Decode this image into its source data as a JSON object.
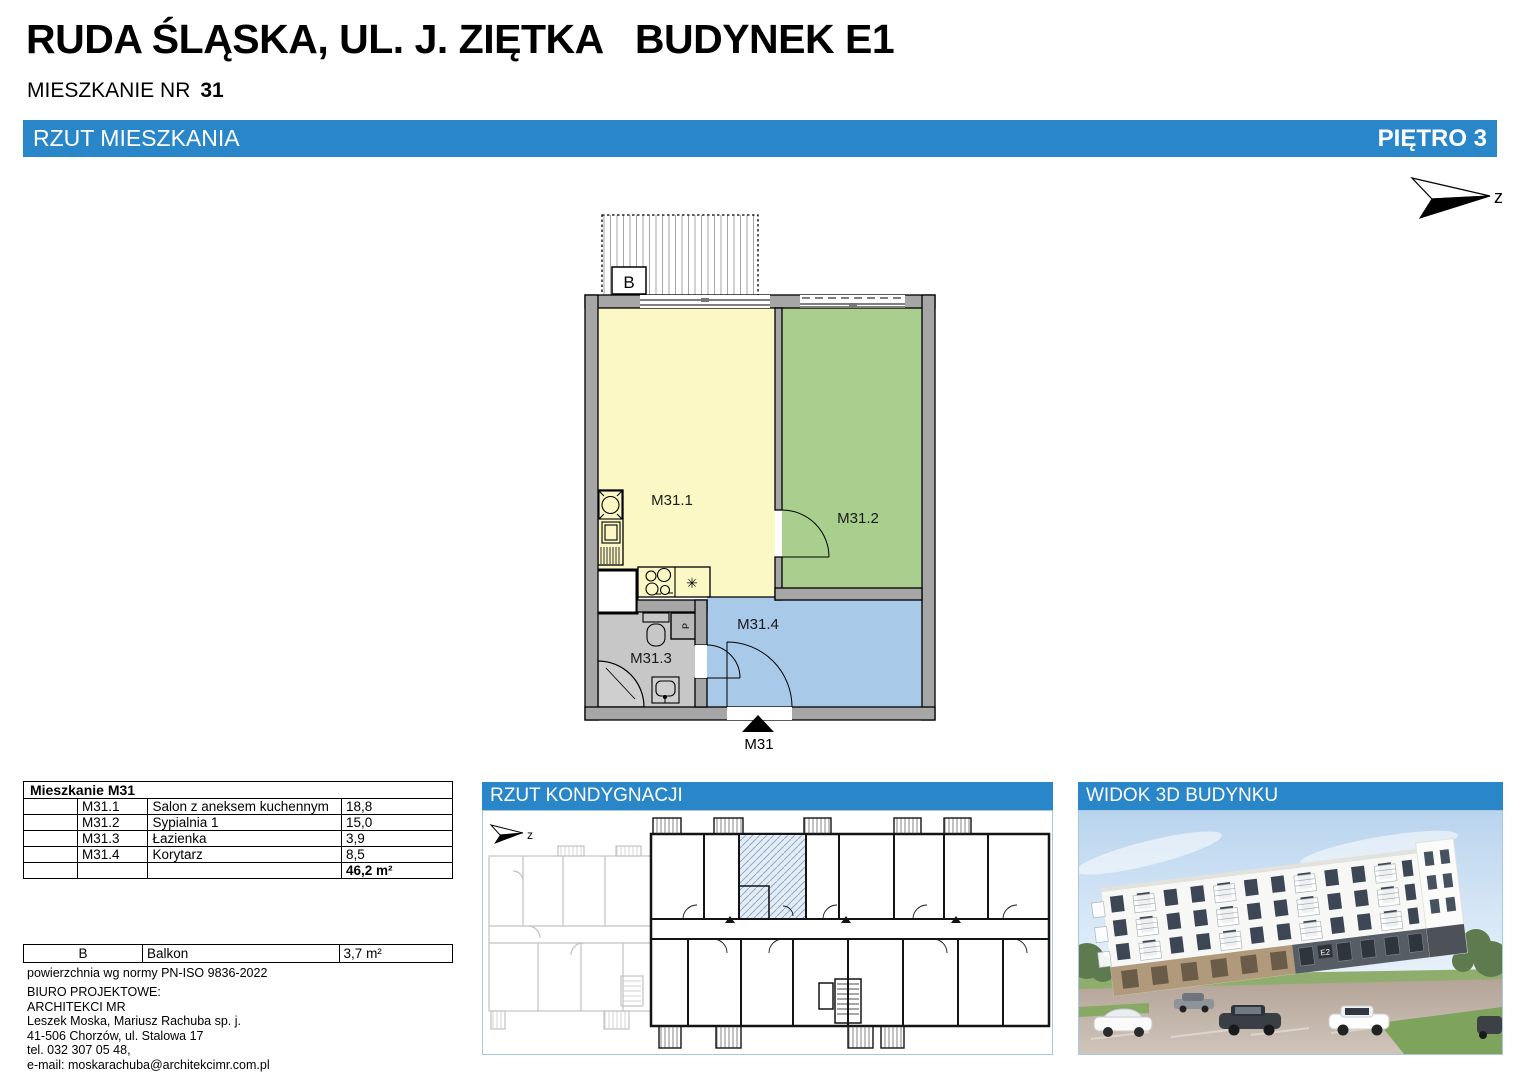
{
  "header": {
    "title": "RUDA ŚLĄSKA, UL. J. ZIĘTKA   BUDYNEK E1",
    "apartment_label": "MIESZKANIE NR",
    "apartment_number": "31"
  },
  "section_bar": {
    "left": "RZUT MIESZKANIA",
    "right": "PIĘTRO 3"
  },
  "compass": {
    "label": "z"
  },
  "floor_plan": {
    "balcony_label": "B",
    "entrance_label": "M31",
    "washer_label": "P",
    "kitchen_symbol": "✳",
    "rooms": [
      {
        "code": "M31.1",
        "name": "Salon z aneksem kuchennym",
        "area": "18,8",
        "color": "#fbf8c5"
      },
      {
        "code": "M31.2",
        "name": "Sypialnia 1",
        "area": "15,0",
        "color": "#a8cf8d"
      },
      {
        "code": "M31.3",
        "name": "Łazienka",
        "area": "3,9",
        "color": "#c7c7c7"
      },
      {
        "code": "M31.4",
        "name": "Korytarz",
        "area": "8,5",
        "color": "#a9c9e9"
      }
    ]
  },
  "area_table": {
    "title": "Mieszkanie M31",
    "total": "46,2 m²"
  },
  "balcony_table": {
    "code": "B",
    "name": "Balkon",
    "area": "3,7 m²"
  },
  "norm_note": "powierzchnia wg normy PN-ISO 9836-2022",
  "office": {
    "lines": [
      "BIURO PROJEKTOWE:",
      "ARCHITEKCI MR",
      "Leszek Moska, Mariusz Rachuba sp. j.",
      "41-506 Chorzów, ul. Stalowa 17",
      "tel. 032 307 05 48,",
      "e-mail: moskarachuba@architekcimr.com.pl"
    ]
  },
  "panels": {
    "floor_overview": {
      "title": "RZUT KONDYGNACJI",
      "compass_label": "z"
    },
    "building_view": {
      "title": "WIDOK 3D BUDYNKU",
      "entrance_label": "E2"
    }
  },
  "colors": {
    "accent_blue": "#2986c8",
    "panel_border": "#a8c8e2",
    "wall_gray": "#a6a6a6",
    "highlight_hatch": "#8fa9c4"
  }
}
